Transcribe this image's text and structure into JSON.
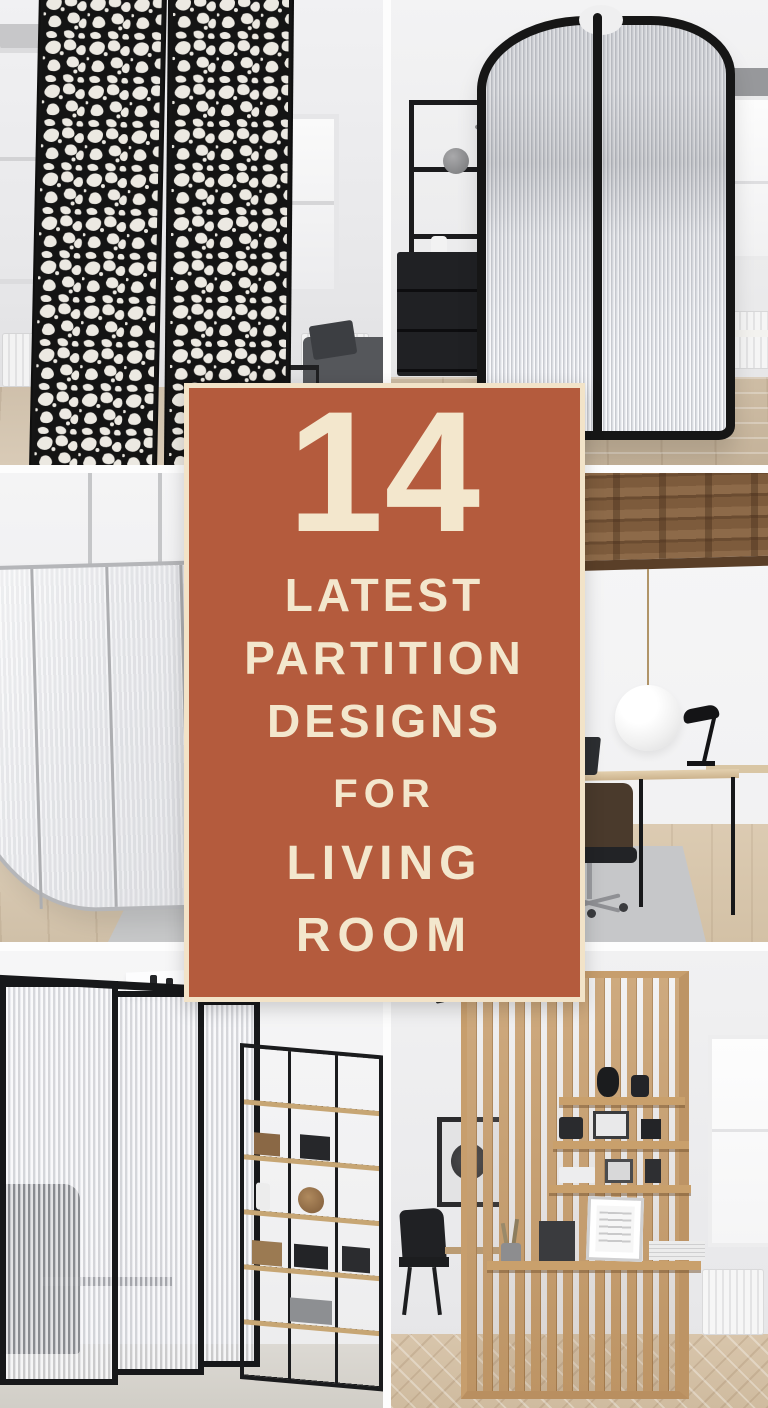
{
  "card": {
    "number": "14",
    "lines": [
      "LATEST",
      "PARTITION",
      "DESIGNS",
      "FOR",
      "LIVING",
      "ROOM"
    ]
  },
  "colors": {
    "card_bg": "#b45b3d",
    "card_text": "#f3e7cd",
    "card_border": "#f2e3c8",
    "seam": "#fdfdfd"
  },
  "photos": [
    {
      "label": "Black laser-cut metal partition panels in a white living room with windows and sofa"
    },
    {
      "label": "Curved fluted glass partition with black frame beside black shelving and window"
    },
    {
      "label": "Curved frosted glass partition with metal frame in front of a tan leather sofa"
    },
    {
      "label": "Home office with exposed wood beam ceiling, globe pendant light and desks"
    },
    {
      "label": "Reeded glass partition wall with black metal grid shelving unit"
    },
    {
      "label": "Wood slat partition with built-in display shelves in a dining area"
    }
  ]
}
